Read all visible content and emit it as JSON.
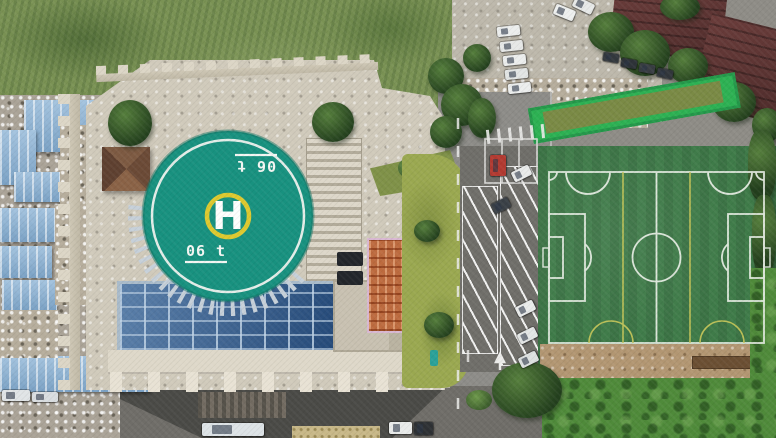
{
  "scene": {
    "type": "aerial-drone-photo",
    "description": "Aerial top-down view of a hospital building with a rooftop helipad and glass atrium, flanked by blue-roofed sheds, a street with angled parking, and an artificial-turf soccer field",
    "helipad": {
      "letter": "H",
      "weight_limit_top": "06 t",
      "weight_limit_bottom": "06 t",
      "pad_color": "#18917f",
      "inner_ring_color": "#ddc92f",
      "marking_color": "#f4f7f3"
    },
    "soccer_field": {
      "turf_color": "#3f7b49",
      "line_color_primary": "#e9efe6",
      "line_color_secondary": "#c9c85a",
      "features": [
        "boundary",
        "halfway-line",
        "center-circle",
        "penalty-area-left",
        "penalty-area-right",
        "goal-area-left",
        "goal-area-right",
        "penalty-arcs",
        "cross-pitch-yellow-lines",
        "corner-arcs"
      ]
    },
    "palette": {
      "grass_field": "#7a9254",
      "pavement": "#bdb8ab",
      "courtyard": "#d0cabb",
      "road": "#8d8c88",
      "parking_asphalt": "#6f6e69",
      "blue_roof": "#8fb3d4",
      "glass_roof": "#2d5c92",
      "maroon_roof": "#5d3736",
      "green_roof": "#2db153",
      "dirt": "#b29672",
      "lawn": "#9aa850",
      "vegetation": "#4f8a3a",
      "orange_structure": "#bd6b3f",
      "pavilion_roof": "#6b4a36"
    },
    "vehicles": [
      {
        "name": "red-car",
        "color": "#b23a31",
        "x": 490,
        "y": 155,
        "w": 16,
        "h": 21,
        "rot": 0
      },
      {
        "name": "white-car",
        "color": "#e9ebea",
        "x": 512,
        "y": 168,
        "w": 19,
        "h": 11,
        "rot": -26
      },
      {
        "name": "dark-car",
        "color": "#3a4046",
        "x": 492,
        "y": 200,
        "w": 18,
        "h": 11,
        "rot": -26
      },
      {
        "name": "white-car",
        "color": "#e9ebea",
        "x": 516,
        "y": 303,
        "w": 19,
        "h": 11,
        "rot": -26
      },
      {
        "name": "white-car",
        "color": "#e3e6e5",
        "x": 518,
        "y": 330,
        "w": 19,
        "h": 11,
        "rot": -26
      },
      {
        "name": "white-car",
        "color": "#dde1e0",
        "x": 519,
        "y": 354,
        "w": 19,
        "h": 11,
        "rot": -26
      },
      {
        "name": "white-car",
        "color": "#eceeed",
        "x": 497,
        "y": 26,
        "w": 23,
        "h": 10,
        "rot": -6
      },
      {
        "name": "white-car",
        "color": "#e6e8e7",
        "x": 500,
        "y": 41,
        "w": 23,
        "h": 10,
        "rot": -6
      },
      {
        "name": "white-car",
        "color": "#eceeed",
        "x": 503,
        "y": 55,
        "w": 23,
        "h": 10,
        "rot": -6
      },
      {
        "name": "white-car",
        "color": "#e2e5e4",
        "x": 505,
        "y": 69,
        "w": 23,
        "h": 10,
        "rot": -6
      },
      {
        "name": "white-car",
        "color": "#eceeed",
        "x": 508,
        "y": 83,
        "w": 23,
        "h": 10,
        "rot": -6
      },
      {
        "name": "white-car",
        "color": "#eef0ef",
        "x": 554,
        "y": 7,
        "w": 21,
        "h": 11,
        "rot": 22
      },
      {
        "name": "white-car",
        "color": "#e7e9e8",
        "x": 573,
        "y": 0,
        "w": 21,
        "h": 11,
        "rot": 26
      },
      {
        "name": "dark-car",
        "color": "#33383d",
        "x": 603,
        "y": 53,
        "w": 16,
        "h": 9,
        "rot": 10
      },
      {
        "name": "dark-car",
        "color": "#2e3338",
        "x": 621,
        "y": 59,
        "w": 16,
        "h": 9,
        "rot": 10
      },
      {
        "name": "dark-car",
        "color": "#383d42",
        "x": 639,
        "y": 64,
        "w": 16,
        "h": 9,
        "rot": 10
      },
      {
        "name": "dark-car",
        "color": "#31363b",
        "x": 657,
        "y": 69,
        "w": 16,
        "h": 9,
        "rot": 12
      },
      {
        "name": "shuttle-bus",
        "color": "#dde3e6",
        "x": 202,
        "y": 423,
        "w": 62,
        "h": 13,
        "rot": 0
      },
      {
        "name": "white-car",
        "color": "#e9ebea",
        "x": 389,
        "y": 422,
        "w": 23,
        "h": 12,
        "rot": 0
      },
      {
        "name": "dark-car",
        "color": "#2e3134",
        "x": 414,
        "y": 422,
        "w": 19,
        "h": 13,
        "rot": 0
      },
      {
        "name": "white-truck",
        "color": "#e0e4e6",
        "x": 2,
        "y": 390,
        "w": 28,
        "h": 11,
        "rot": 0
      },
      {
        "name": "white-truck",
        "color": "#d9dde0",
        "x": 32,
        "y": 392,
        "w": 26,
        "h": 10,
        "rot": 0
      }
    ]
  }
}
